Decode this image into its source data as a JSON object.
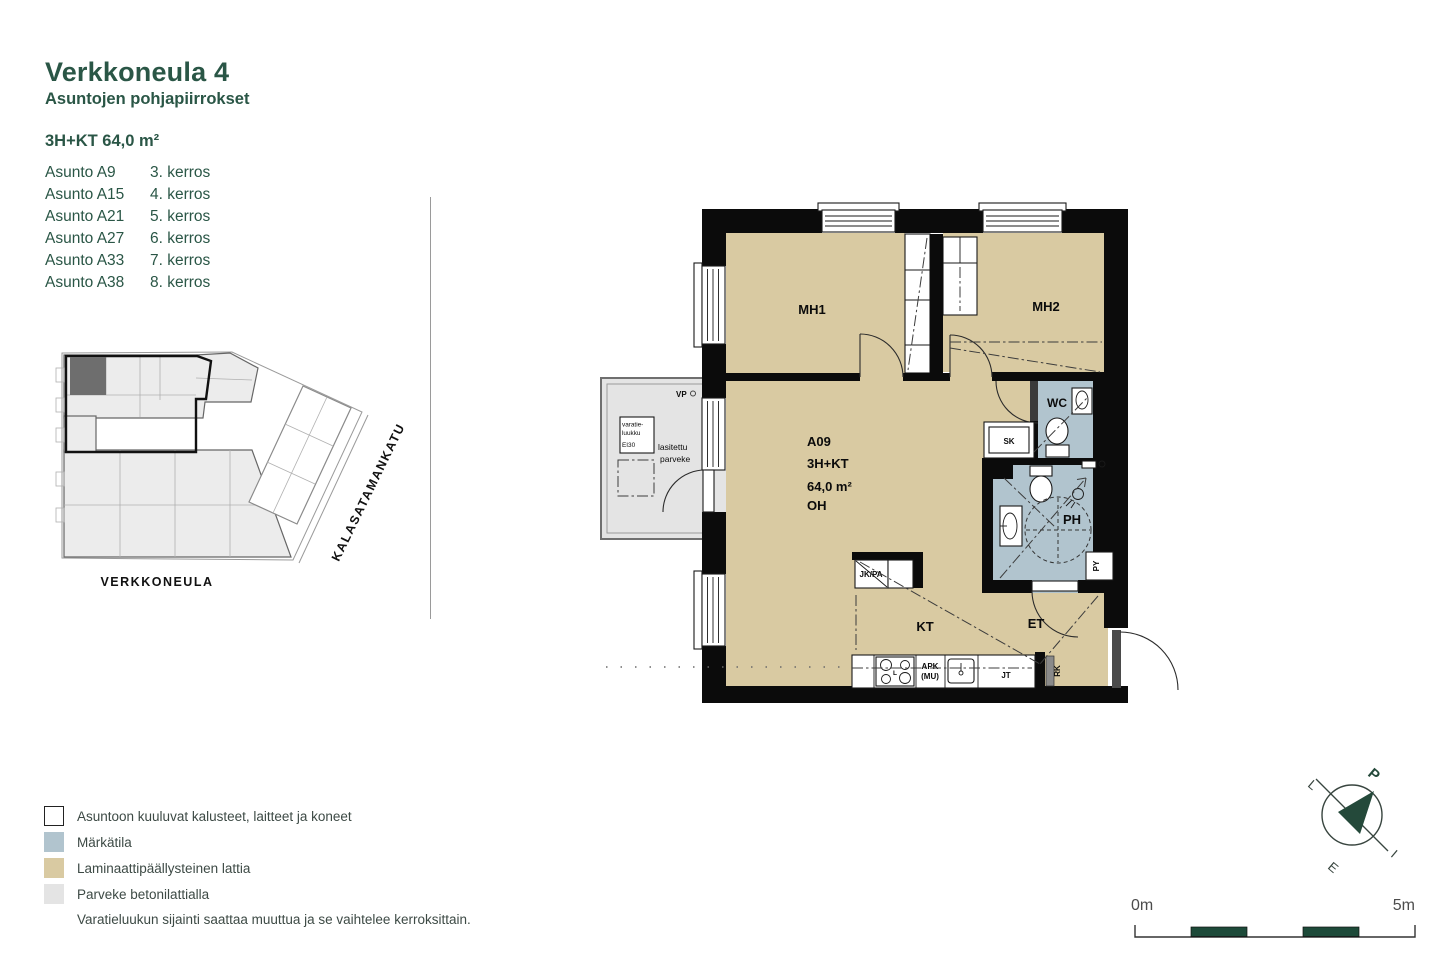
{
  "header": {
    "title": "Verkkoneula 4",
    "subtitle": "Asuntojen pohjapiirrokset",
    "unit_type": "3H+KT 64,0 m²",
    "units": [
      {
        "name": "Asunto A9",
        "floor": "3. kerros"
      },
      {
        "name": "Asunto A15",
        "floor": "4. kerros"
      },
      {
        "name": "Asunto A21",
        "floor": "5. kerros"
      },
      {
        "name": "Asunto A27",
        "floor": "6. kerros"
      },
      {
        "name": "Asunto A33",
        "floor": "7. kerros"
      },
      {
        "name": "Asunto A38",
        "floor": "8. kerros"
      }
    ]
  },
  "site_plan": {
    "building_label": "VERKKONEULA",
    "street_label": "KALASATAMANKATU"
  },
  "floor_plan": {
    "unit_id": "A09",
    "unit_type": "3H+KT",
    "unit_area": "64,0 m²",
    "rooms": {
      "mh1": "MH1",
      "mh2": "MH2",
      "wc": "WC",
      "ph": "PH",
      "oh": "OH",
      "kt": "KT",
      "et": "ET"
    },
    "fixtures": {
      "sk": "SK",
      "py": "PY",
      "jk_pa": "JK/PA",
      "apk_line1": "APK",
      "apk_line2": "(MU)",
      "jt": "JT",
      "rk": "RK",
      "stove": "L"
    },
    "balcony": {
      "vp": "VP",
      "hatch_line1": "varatie-",
      "hatch_line2": "luukku",
      "hatch_line3": "EI30",
      "glazed_line1": "lasitettu",
      "glazed_line2": "parveke"
    }
  },
  "legend": {
    "items": [
      {
        "label": "Asuntoon kuuluvat kalusteet, laitteet ja koneet",
        "color": "#ffffff"
      },
      {
        "label": "Märkätila",
        "color": "#b1c4ce"
      },
      {
        "label": "Laminaattipäällysteinen lattia",
        "color": "#d9caa2"
      },
      {
        "label": "Parveke betonilattialla",
        "color": "#e4e4e4"
      }
    ],
    "note": "Varatieluukun sijainti saattaa muuttua ja se vaihtelee kerroksittain."
  },
  "scale_bar": {
    "start": "0m",
    "end": "5m"
  },
  "compass": {
    "north": "P",
    "east": "I",
    "south": "E",
    "west": "L"
  },
  "colors": {
    "accent_green": "#2a5646",
    "wall_black": "#0b0b0b",
    "laminate": "#d9caa2",
    "wet_room": "#b1c4ce",
    "balcony_gray": "#e4e4e4",
    "scale_green": "#1d4a39"
  }
}
